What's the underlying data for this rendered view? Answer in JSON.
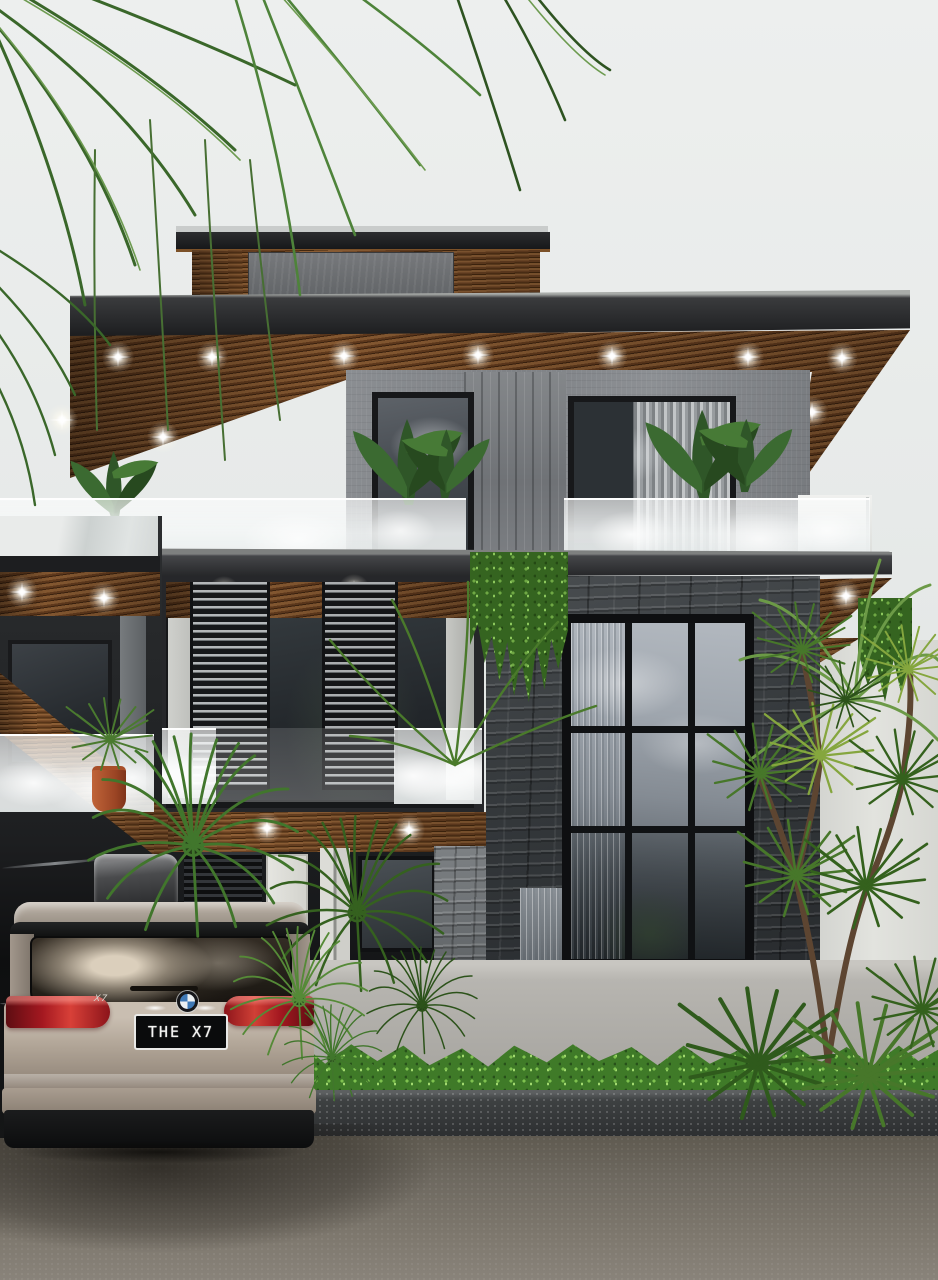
{
  "scene": {
    "type": "3D architectural exterior render",
    "description": "Modern three-storey villa with cantilevered wood-slat soffits and recessed downlights, frosted glass balcony balustrades, vertical louver window screens, a dark stacked-stone feature wall with a black steel grid window, hanging vine garden, tropical landscaping and a BMW X7 parked on the driveway under an overcast sky",
    "lighting": "overcast daylight with warm soffit downlights switched on"
  },
  "vehicle": {
    "description": "champagne-silver BMW X7 SUV seen from the rear, roof cargo box fitted",
    "license_plate": "THE X7",
    "tailgate_badge": "X7",
    "logo": "bmw-roundel"
  },
  "house": {
    "storeys": 3,
    "features": [
      "flat stacked roofs with dark fascias and wood-slat soffits",
      "recessed circular downlights in all soffits",
      "grey concrete panel cladding on upper floor",
      "frosted glass balustrades with banana plants",
      "dark louvered screen box on middle floor",
      "charcoal stacked-stone feature wall",
      "three-column black steel grid window reflecting the sky",
      "cascading vine garden between floors",
      "white entry door",
      "light grey stucco perimeter fence with boxwood hedge and stone curb"
    ]
  },
  "landscaping": [
    "overhanging palm fronds at top left",
    "sago palm cycads around the car",
    "branching dracaena trees on the right",
    "clipped green hedge row along the fence"
  ],
  "palette": {
    "sky": "#e9eceb",
    "roof_fascia": "#26272a",
    "wood_slats": "#7a4e2a",
    "concrete_panel": "#85888c",
    "stone_wall": "#34383b",
    "grid_glass_reflection": "#9aa1a9",
    "balustrade_frost": "#f2f4f4",
    "hedge_green": "#3f7a28",
    "palm_green": "#45722c",
    "car_champagne": "#b2a698",
    "taillight_red": "#b3201f",
    "plate_black": "#0a0b0c",
    "driveway_asphalt": "#6e695f",
    "fence_grey": "#b5b3ae",
    "terracotta_pot": "#b05a31"
  }
}
